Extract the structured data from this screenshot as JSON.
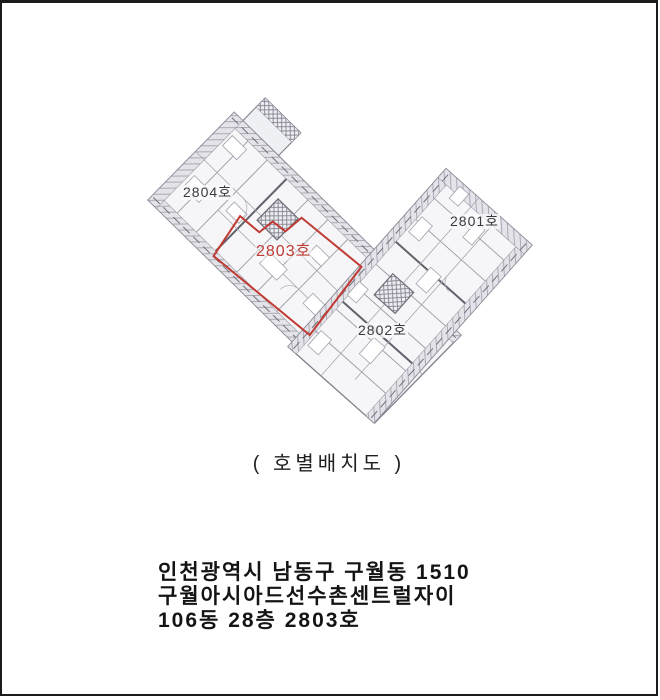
{
  "page": {
    "background": "#ffffff",
    "border_color": "#1b1b1b"
  },
  "plan": {
    "caption": "( 호별배치도 )",
    "units": [
      {
        "number": "2804",
        "label": "2804호",
        "highlighted": false
      },
      {
        "number": "2801",
        "label": "2801호",
        "highlighted": false
      },
      {
        "number": "2803",
        "label": "2803호",
        "highlighted": true
      },
      {
        "number": "2802",
        "label": "2802호",
        "highlighted": false
      }
    ],
    "highlight_color": "#bf3b33",
    "label_color": "#3a3a3e",
    "linework_color": "#85858f"
  },
  "address": {
    "line1": "인천광역시 남동구 구월동 1510",
    "line2": "구월아시아드선수촌센트럴자이",
    "line3": "106동 28층 2803호"
  }
}
